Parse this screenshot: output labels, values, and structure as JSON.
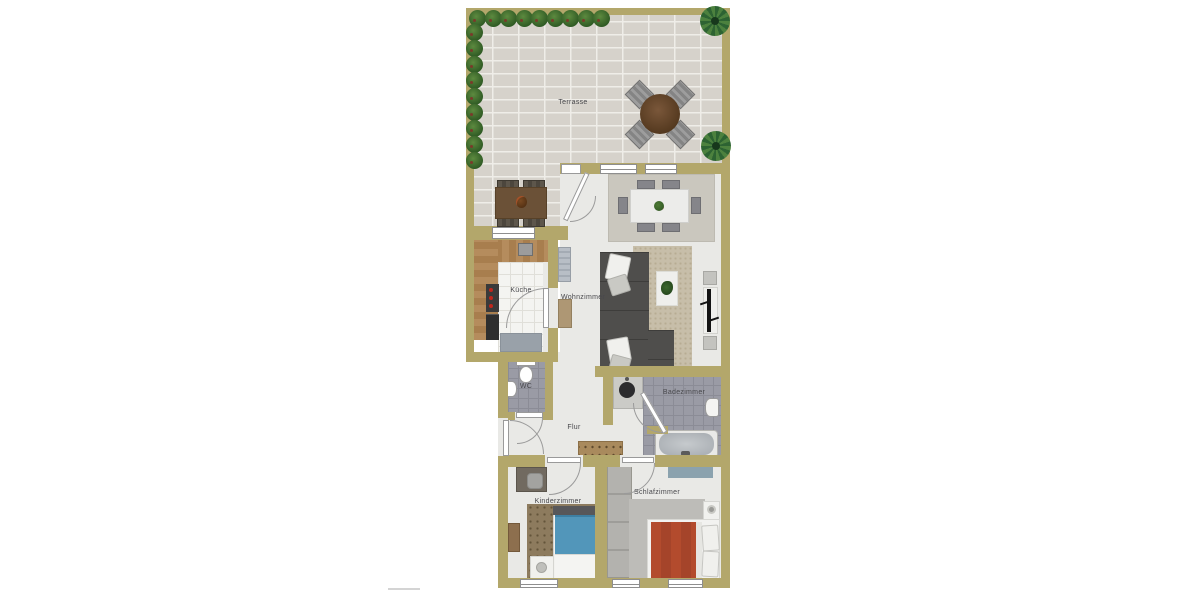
{
  "floorplan": {
    "rooms": {
      "terrasse": {
        "label": "Terrasse"
      },
      "kueche": {
        "label": "Küche"
      },
      "wohnzimmer": {
        "label": "Wohnzimmer"
      },
      "flur": {
        "label": "Flur"
      },
      "wc": {
        "label": "WC"
      },
      "badezimmer": {
        "label": "Badezimmer"
      },
      "kinderzimmer": {
        "label": "Kinderzimmer"
      },
      "schlafzimmer": {
        "label": "Schlafzimmer"
      }
    },
    "colors": {
      "wall": "#b3a76b",
      "floor": "#e9e9e6",
      "terrace_brick": "#d6d2cb",
      "kitchen_tile": "#f4f4f1",
      "tile_gray": "#9a9ba5",
      "sofa": "#4f4e4c",
      "bed_red": "#b34b2d",
      "bed_blue": "#5296ba",
      "rug_beige": "#c7bea9"
    }
  }
}
